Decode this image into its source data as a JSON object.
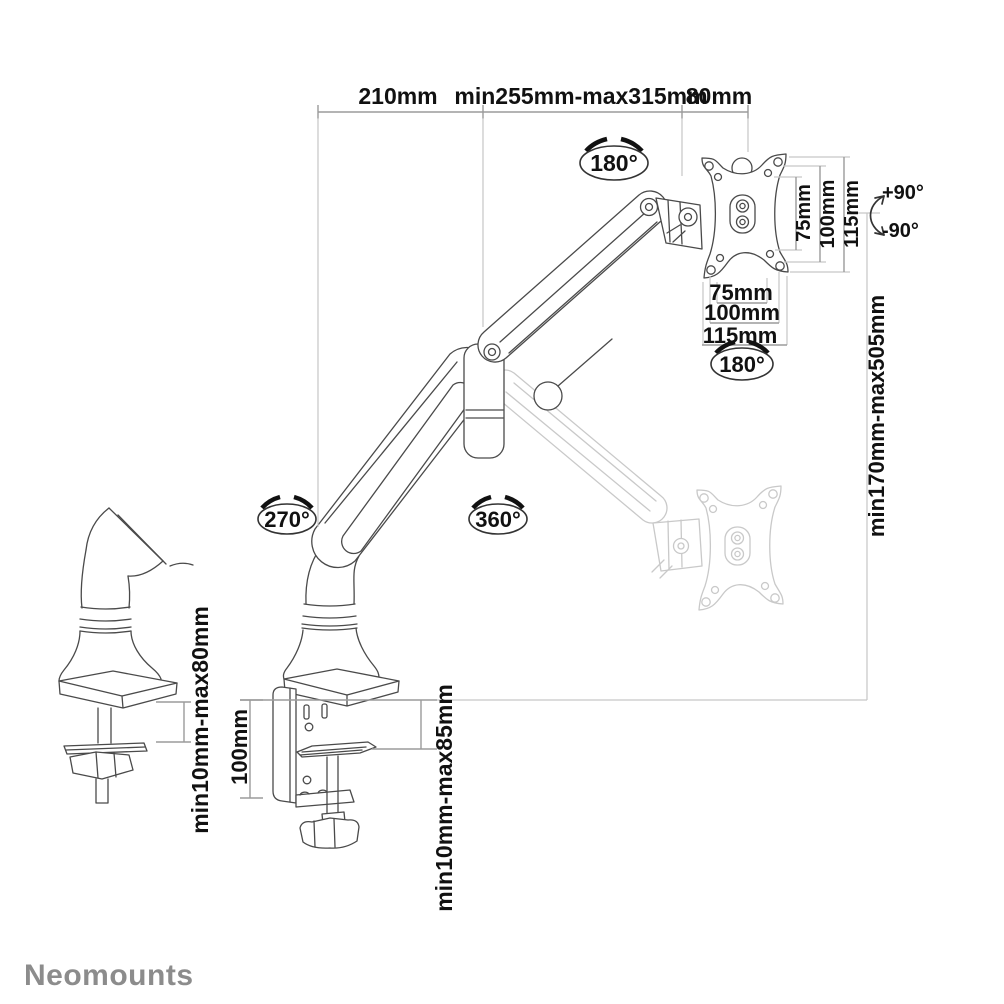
{
  "brand": {
    "logo": "Neomounts"
  },
  "colors": {
    "background": "#ffffff",
    "solid_line": "#4a4a4a",
    "ghost_line": "#c9c9c9",
    "dimension_line": "#9b9b9b",
    "extension_line": "#c6c6c6",
    "text": "#111111",
    "logo": "#8c8c8c"
  },
  "dims": {
    "top": [
      "210mm",
      "min255mm-max315mm",
      "80mm"
    ],
    "vesa_side": [
      "75mm",
      "100mm",
      "115mm"
    ],
    "vesa_bottom": [
      "75mm",
      "100mm",
      "115mm"
    ],
    "height_range": "min170mm-max505mm",
    "clamp_height": "100mm",
    "grip_main": "min10mm-max85mm",
    "grip_detail": "min10mm-max80mm"
  },
  "rotations": {
    "top_joint": "180°",
    "vesa": "180°",
    "base": "270°",
    "arm": "360°",
    "tilt_up": "+90°",
    "tilt_down": "-90°"
  }
}
